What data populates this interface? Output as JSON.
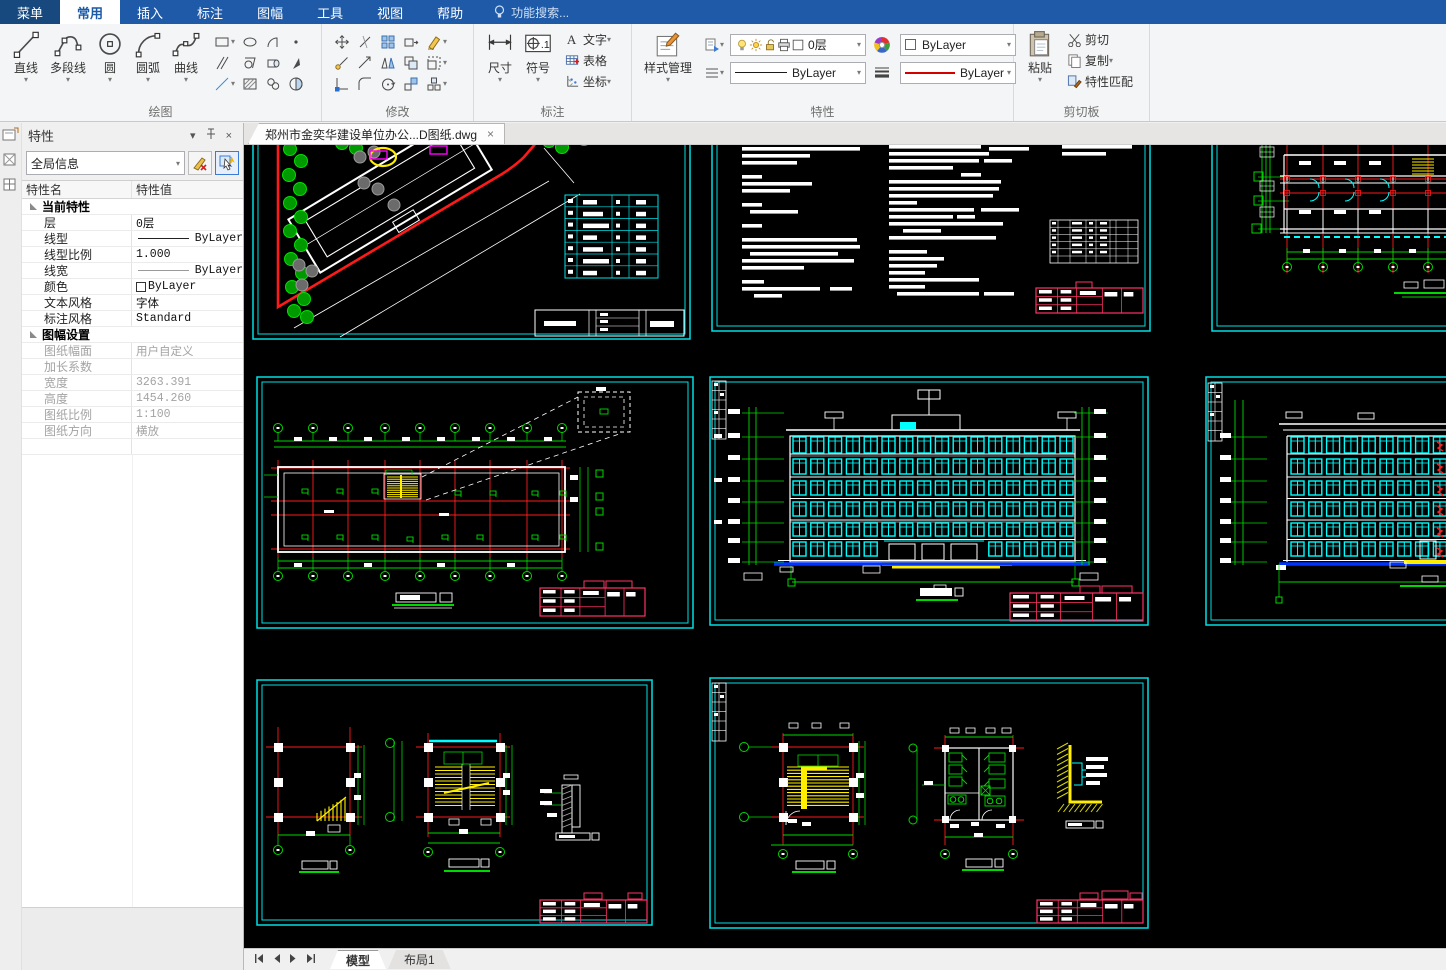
{
  "menu_bar": {
    "items": [
      {
        "label": "菜单",
        "type": "menu-root"
      },
      {
        "label": "常用",
        "active": true
      },
      {
        "label": "插入"
      },
      {
        "label": "标注"
      },
      {
        "label": "图幅"
      },
      {
        "label": "工具"
      },
      {
        "label": "视图"
      },
      {
        "label": "帮助"
      }
    ],
    "search_label": "功能搜索..."
  },
  "ribbon": {
    "draw": {
      "label": "绘图",
      "big_buttons": [
        {
          "label": "直线",
          "icon": "line"
        },
        {
          "label": "多段线",
          "icon": "polyline"
        },
        {
          "label": "圆",
          "icon": "circle"
        },
        {
          "label": "圆弧",
          "icon": "arc"
        },
        {
          "label": "曲线",
          "icon": "spline"
        }
      ],
      "grid": [
        [
          "rectangle",
          "ellipse",
          "arc-segment",
          "point"
        ],
        [
          "parallel-lines",
          "region",
          "cylinder",
          "pick-point"
        ],
        [
          "construction-line",
          "hatch",
          "block",
          "boundary"
        ]
      ],
      "grid_dropdowns": [
        "rectangle",
        "construction-line"
      ]
    },
    "modify": {
      "label": "修改",
      "grid": [
        [
          "move",
          "break",
          "array",
          "stretch",
          "erase"
        ],
        [
          "copy",
          "lengthen",
          "mirror",
          "offset",
          "scale"
        ],
        [
          "grip-edit",
          "fillet",
          "rotate",
          "align",
          "explode"
        ]
      ],
      "grid_dropdowns": [
        "erase",
        "scale",
        "explode"
      ]
    },
    "annotate": {
      "label": "标注",
      "big_buttons": [
        {
          "label": "尺寸",
          "icon": "dimension"
        },
        {
          "label": "符号",
          "icon": "symbol"
        }
      ],
      "list": [
        {
          "label": "文字",
          "icon": "text",
          "dropdown": true
        },
        {
          "label": "表格",
          "icon": "table"
        },
        {
          "label": "坐标",
          "icon": "coordinate",
          "dropdown": true
        }
      ]
    },
    "properties": {
      "label": "特性",
      "style_button": {
        "label": "样式管理",
        "icon": "style-manager"
      },
      "layer_combo": {
        "value": "0层"
      },
      "color_combo": {
        "value": "ByLayer"
      },
      "linetype_combo": {
        "value": "ByLayer"
      },
      "lineweight_combo": {
        "value": "ByLayer"
      }
    },
    "clipboard": {
      "label": "剪切板",
      "paste": {
        "label": "粘贴",
        "icon": "paste"
      },
      "items": [
        {
          "label": "剪切",
          "icon": "cut"
        },
        {
          "label": "复制",
          "icon": "copy-doc",
          "dropdown": true
        },
        {
          "label": "特性匹配",
          "icon": "match-props"
        }
      ]
    }
  },
  "properties_panel": {
    "title": "特性",
    "selector_value": "全局信息",
    "table": {
      "name_header": "特性名",
      "value_header": "特性值",
      "sections": [
        {
          "title": "当前特性",
          "rows": [
            {
              "name": "层",
              "value": "0层"
            },
            {
              "name": "线型",
              "value": "ByLayer",
              "glyph": "linetype"
            },
            {
              "name": "线型比例",
              "value": "1.000"
            },
            {
              "name": "线宽",
              "value": "ByLayer",
              "glyph": "lineweight"
            },
            {
              "name": "颜色",
              "value": "ByLayer",
              "glyph": "swatch"
            },
            {
              "name": "文本风格",
              "value": "字体"
            },
            {
              "name": "标注风格",
              "value": "Standard"
            }
          ]
        },
        {
          "title": "图幅设置",
          "disabled": true,
          "rows": [
            {
              "name": "图纸幅面",
              "value": "用户自定义"
            },
            {
              "name": "加长系数",
              "value": ""
            },
            {
              "name": "宽度",
              "value": "3263.391"
            },
            {
              "name": "高度",
              "value": "1454.260"
            },
            {
              "name": "图纸比例",
              "value": "1:100"
            },
            {
              "name": "图纸方向",
              "value": "横放"
            }
          ]
        }
      ]
    }
  },
  "document_tab": {
    "title": "郑州市金奕华建设单位办公...D图纸.dwg",
    "close": "×"
  },
  "canvas": {
    "sheets": [
      {
        "id": "site-plan"
      },
      {
        "id": "design-notes"
      },
      {
        "id": "floor-plan-partial"
      },
      {
        "id": "roof-plan"
      },
      {
        "id": "front-elevation"
      },
      {
        "id": "side-elevation-partial"
      },
      {
        "id": "stair-details"
      },
      {
        "id": "stair-and-toilet-details"
      }
    ],
    "colors": {
      "frame": "#00e0e6",
      "dims": "#00d900",
      "grid": "#ff1a1a",
      "stairs": "#ffee00",
      "titleblock": "#ff3366",
      "ground": "#0033ff"
    }
  },
  "bottom_bar": {
    "tabs": [
      {
        "label": "模型",
        "active": true
      },
      {
        "label": "布局1",
        "active": false
      }
    ]
  }
}
